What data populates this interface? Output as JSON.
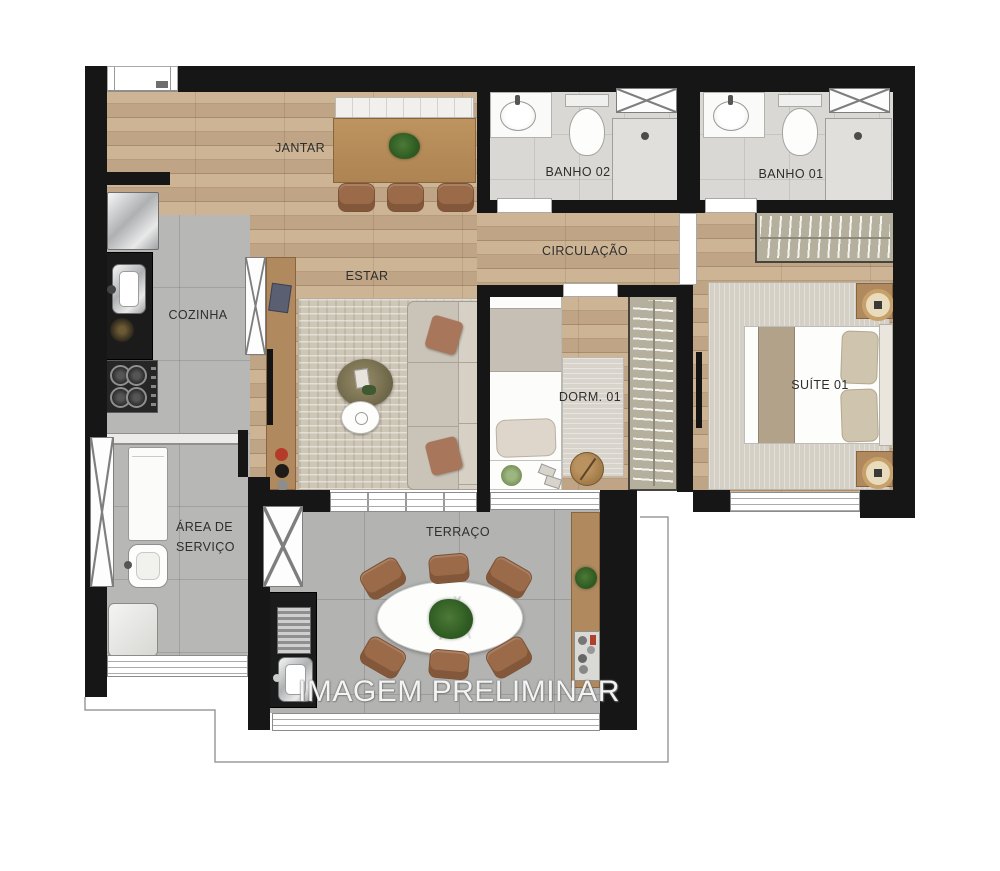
{
  "plan": {
    "watermark": "IMAGEM PRELIMINAR",
    "rooms": {
      "jantar": {
        "label": "JANTAR"
      },
      "banho02": {
        "label": "BANHO 02"
      },
      "banho01": {
        "label": "BANHO 01"
      },
      "circulacao": {
        "label": "CIRCULAÇÃO"
      },
      "estar": {
        "label": "ESTAR"
      },
      "cozinha": {
        "label": "COZINHA"
      },
      "dorm01": {
        "label": "DORM. 01"
      },
      "suite01": {
        "label": "SUÍTE 01"
      },
      "area_servico": {
        "label": "ÁREA DE SERVIÇO"
      },
      "terraco": {
        "label": "TERRAÇO"
      }
    },
    "colors": {
      "wall": "#161616",
      "wood_floor": "#c9ae8c",
      "tile_floor": "#b7b7b5",
      "bath_floor": "#d9d8d4",
      "terrace_floor": "#b3b4b2",
      "rug": "#cec6b7",
      "furniture_wood": "#b08a5e",
      "chair_brown": "#9b6a49",
      "counter_black": "#1b1b1b",
      "label_text": "#2e2e2e",
      "watermark_text": "#cccccc"
    }
  }
}
